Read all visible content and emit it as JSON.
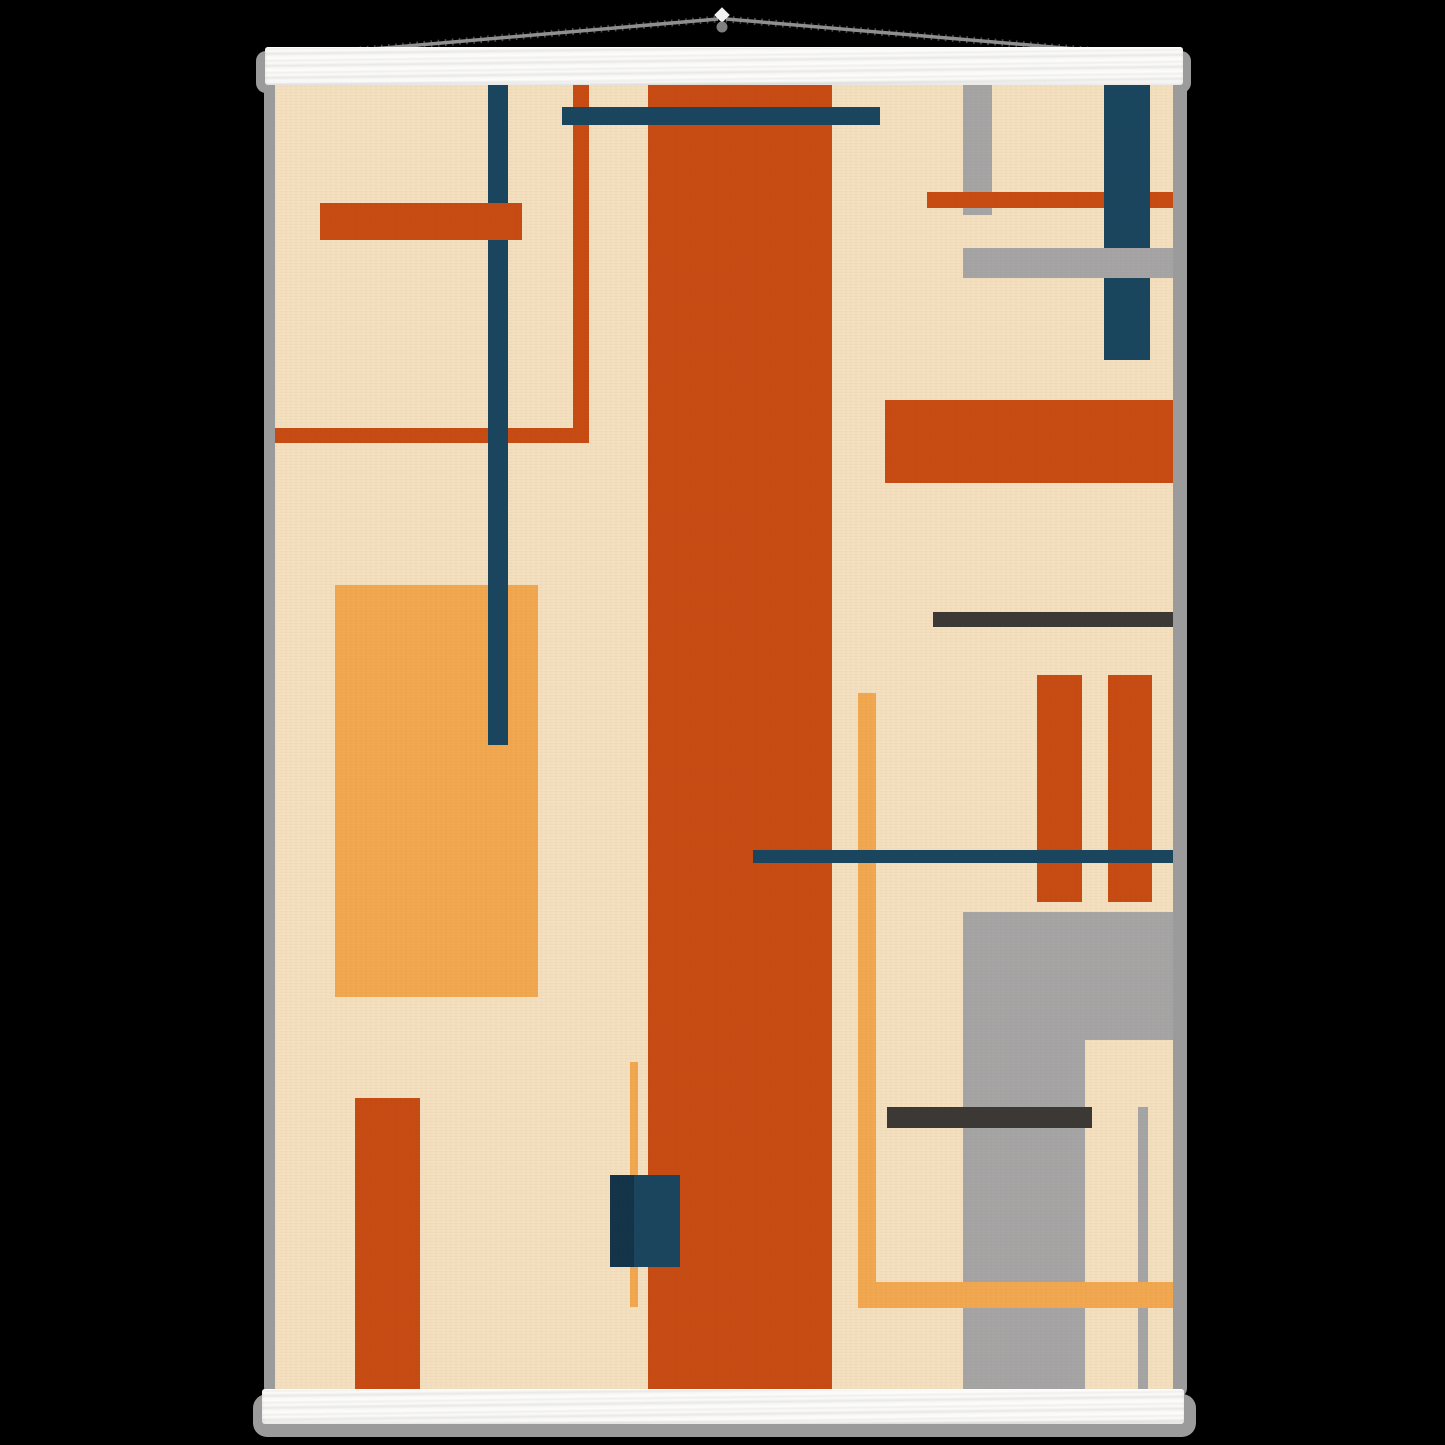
{
  "scene": {
    "description": "Abstract geometric Bauhaus-style art poster in cream, rust orange, amber, navy and gray, hanging on white wooden poster rails with a gray cord",
    "background_color": "#000000"
  },
  "palette": {
    "bg": "#000000",
    "cream": "#f4e0bf",
    "rust": "#c74b13",
    "amber": "#f2a850",
    "navy": "#19455f",
    "navy_dark": "#123349",
    "gray": "#a6a5a6",
    "dark_gray": "#3b3836",
    "shadow": "#9b9b9b",
    "bar_white": "#f7f7f6",
    "cord_gray": "#8f8f8f",
    "knob_gray": "#7f7f7f"
  },
  "hanger": {
    "cord": {
      "left_x": 268,
      "left_y": 58,
      "right_x": 1180,
      "right_y": 58,
      "apex_x": 722,
      "apex_y": 19,
      "knob_cx": 722,
      "knob_cy": 27,
      "knob_r": 5.5,
      "tip_cx": 722,
      "tip_cy": 15,
      "tip_size": 11
    },
    "top_bar": {
      "x": 265,
      "y": 47,
      "w": 918,
      "h": 38
    },
    "bottom_bar": {
      "x": 262,
      "y": 1389,
      "w": 922,
      "h": 35
    }
  },
  "poster": {
    "rect": {
      "x": 275,
      "y": 85,
      "w": 898,
      "h": 1304
    },
    "shapes": [
      {
        "name": "amber-rect-left",
        "x": 60,
        "y": 500,
        "w": 203,
        "h": 412,
        "color": "amber"
      },
      {
        "name": "rust-line-vertical-topleft",
        "x": 298,
        "y": 0,
        "w": 16,
        "h": 358,
        "color": "rust"
      },
      {
        "name": "rust-line-horizontal-left",
        "x": 0,
        "y": 343,
        "w": 314,
        "h": 15,
        "color": "rust"
      },
      {
        "name": "navy-line-vertical-left",
        "x": 213,
        "y": 0,
        "w": 20,
        "h": 660,
        "color": "navy"
      },
      {
        "name": "rust-bar-topleft",
        "x": 45,
        "y": 118,
        "w": 202,
        "h": 37,
        "color": "rust"
      },
      {
        "name": "rust-stripe-center",
        "x": 373,
        "y": 0,
        "w": 184,
        "h": 1304,
        "color": "rust"
      },
      {
        "name": "navy-bar-top",
        "x": 287,
        "y": 22,
        "w": 318,
        "h": 18,
        "color": "navy"
      },
      {
        "name": "gray-bar-vertical-topright",
        "x": 688,
        "y": 0,
        "w": 29,
        "h": 130,
        "color": "gray"
      },
      {
        "name": "rust-bar-topright",
        "x": 652,
        "y": 107,
        "w": 246,
        "h": 16,
        "color": "rust"
      },
      {
        "name": "navy-bar-vertical-topright",
        "x": 829,
        "y": 0,
        "w": 46,
        "h": 275,
        "color": "navy"
      },
      {
        "name": "gray-bar-horizontal-topright",
        "x": 688,
        "y": 163,
        "w": 210,
        "h": 30,
        "color": "gray"
      },
      {
        "name": "rust-rect-right",
        "x": 610,
        "y": 315,
        "w": 288,
        "h": 83,
        "color": "rust"
      },
      {
        "name": "darkgray-line-right",
        "x": 658,
        "y": 527,
        "w": 240,
        "h": 15,
        "color": "dark_gray"
      },
      {
        "name": "rust-bar-vertical-right-1",
        "x": 762,
        "y": 590,
        "w": 45,
        "h": 227,
        "color": "rust"
      },
      {
        "name": "rust-bar-vertical-right-2",
        "x": 833,
        "y": 590,
        "w": 44,
        "h": 227,
        "color": "rust"
      },
      {
        "name": "amber-line-vertical-right",
        "x": 583,
        "y": 608,
        "w": 18,
        "h": 615,
        "color": "amber"
      },
      {
        "name": "gray-rect-bottomright",
        "x": 688,
        "y": 827,
        "w": 210,
        "h": 477,
        "color": "gray"
      },
      {
        "name": "cream-notch-bottomright",
        "x": 810,
        "y": 955,
        "w": 88,
        "h": 349,
        "color": "cream"
      },
      {
        "name": "darkgray-bar-bottomright",
        "x": 612,
        "y": 1022,
        "w": 205,
        "h": 21,
        "color": "dark_gray"
      },
      {
        "name": "gray-line-vertical-bottomright",
        "x": 863,
        "y": 1022,
        "w": 10,
        "h": 282,
        "color": "gray"
      },
      {
        "name": "navy-line-middle",
        "x": 478,
        "y": 765,
        "w": 420,
        "h": 13,
        "color": "navy"
      },
      {
        "name": "amber-bar-bottomright",
        "x": 583,
        "y": 1197,
        "w": 315,
        "h": 26,
        "color": "amber"
      },
      {
        "name": "rust-rect-bottomleft",
        "x": 80,
        "y": 1013,
        "w": 65,
        "h": 291,
        "color": "rust"
      },
      {
        "name": "amber-line-vertical-bottomleft",
        "x": 355,
        "y": 977,
        "w": 8,
        "h": 245,
        "color": "amber"
      },
      {
        "name": "navy-rect-bottomleft",
        "x": 335,
        "y": 1090,
        "w": 70,
        "h": 92,
        "color": "navy"
      },
      {
        "name": "navy-rect-bottomleft-shade",
        "x": 335,
        "y": 1090,
        "w": 24,
        "h": 92,
        "color": "navy_dark"
      }
    ]
  }
}
